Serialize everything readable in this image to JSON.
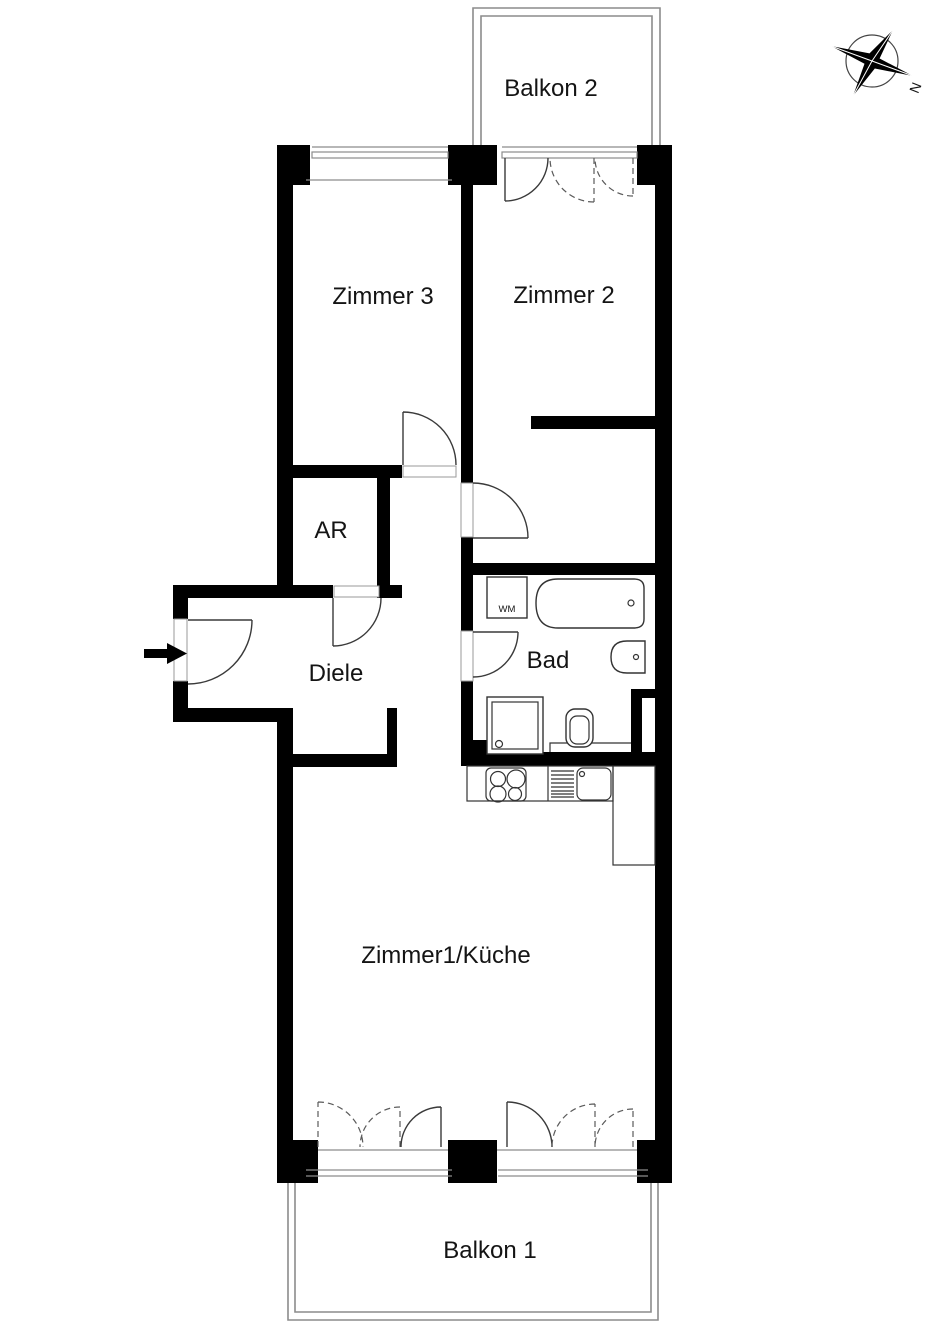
{
  "floorplan": {
    "labels": {
      "balkon2": "Balkon 2",
      "zimmer3": "Zimmer 3",
      "zimmer2": "Zimmer 2",
      "ar": "AR",
      "diele": "Diele",
      "bad": "Bad",
      "wm": "WM",
      "zimmer1_kueche": "Zimmer1/Küche",
      "balkon1": "Balkon 1",
      "compass_north": "N"
    },
    "colors": {
      "background": "#ffffff",
      "wall": "#000000",
      "door_line": "#3a3a3a",
      "thin_line": "#8c8c8c",
      "text": "#141414"
    }
  }
}
